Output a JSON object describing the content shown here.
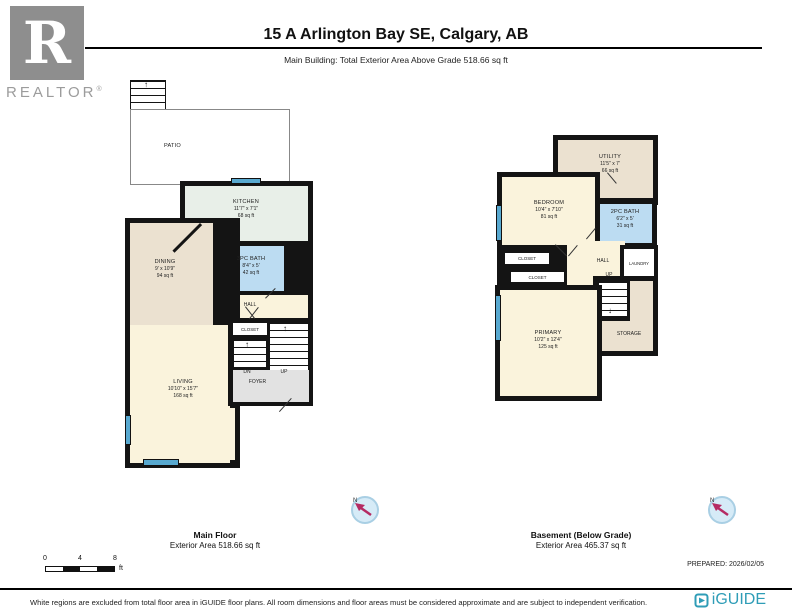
{
  "header": {
    "title": "15 A Arlington Bay SE, Calgary, AB",
    "subtitle": "Main Building: Total Exterior Area Above Grade 518.66 sq ft",
    "realtor_letter": "R",
    "realtor_text": "REALTOR",
    "realtor_reg": "®"
  },
  "floors": [
    {
      "caption_name": "Main Floor",
      "caption_area": "Exterior Area 518.66 sq ft",
      "rooms": {
        "patio": {
          "name": "PATIO"
        },
        "kitchen": {
          "name": "KITCHEN",
          "dims": "11'7\" x 7'1\"",
          "area": "68 sq ft"
        },
        "dining": {
          "name": "DINING",
          "dims": "9' x 10'9\"",
          "area": "94 sq ft"
        },
        "bath": {
          "name": "3PC BATH",
          "dims": "8'4\" x 5'",
          "area": "42 sq ft"
        },
        "hall": {
          "name": "HALL"
        },
        "closet": {
          "name": "CLOSET"
        },
        "living": {
          "name": "LIVING",
          "dims": "10'10\" x 15'7\"",
          "area": "168 sq ft"
        },
        "foyer": {
          "name": "FOYER"
        },
        "dn_top": "DN",
        "dn": "DN",
        "up": "UP"
      }
    },
    {
      "caption_name": "Basement (Below Grade)",
      "caption_area": "Exterior Area 465.37 sq ft",
      "rooms": {
        "utility": {
          "name": "UTILITY",
          "dims": "11'5\" x 7'",
          "area": "66 sq ft"
        },
        "bedroom": {
          "name": "BEDROOM",
          "dims": "10'4\" x 7'10\"",
          "area": "81 sq ft"
        },
        "bath": {
          "name": "2PC BATH",
          "dims": "6'2\" x 5'",
          "area": "31 sq ft"
        },
        "closet1": {
          "name": "CLOSET"
        },
        "closet2": {
          "name": "CLOSET"
        },
        "hall": {
          "name": "HALL"
        },
        "laundry": {
          "name": "LAUNDRY"
        },
        "up": "UP",
        "primary": {
          "name": "PRIMARY",
          "dims": "10'2\" x 12'4\"",
          "area": "125 sq ft"
        },
        "storage": {
          "name": "STORAGE"
        }
      }
    }
  ],
  "compass": {
    "north_label": "N"
  },
  "scale_bar": {
    "tick0": "0",
    "tick4": "4",
    "tick8": "8",
    "unit": "ft"
  },
  "prepared": "PREPARED: 2026/02/05",
  "footer": {
    "disclaimer": "White regions are excluded from total floor area in iGUIDE floor plans. All room dimensions and floor areas must be considered approximate and are subject to independent verification.",
    "brand": "iGUIDE"
  },
  "colors": {
    "wall": "#141414",
    "room_cream": "#faf3dc",
    "room_tan": "#ebe1d0",
    "room_kitchen": "#e8efe8",
    "room_bath_blue": "#bcdcf2",
    "foyer_gray": "#e2e2e2",
    "window_blue": "#58a9d0",
    "iguide_teal": "#2f9db7",
    "compass_arrow": "#b52b63",
    "realtor_gray": "#8e8e8e"
  }
}
